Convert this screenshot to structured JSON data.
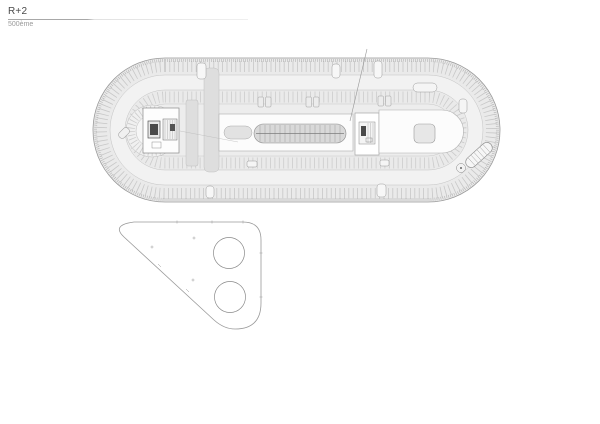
{
  "page": {
    "width": 600,
    "height": 424,
    "background": "#ffffff"
  },
  "titleblock": {
    "title": "R+2",
    "subtitle": "500ème"
  },
  "plan": {
    "upper_figure": "oval-parking-level-plan",
    "upper_features": [
      "perimeter-parking-stalls",
      "circulation-aisles",
      "central-ramp-hatched",
      "helical-ramp",
      "stair-elevator-cores",
      "exterior-stair-detail"
    ],
    "lower_figure": "rounded-triangle-slab-plan",
    "lower_features": [
      "two-circular-openings",
      "survey-tick-marks"
    ],
    "colors": {
      "outline": "#999999",
      "deck_fill": "#eaeaea",
      "aisle_fill": "#f2f2f2",
      "inner_fill": "#ededed",
      "stall_tick": "#c7c7c7",
      "ramp_fill": "#d9d9d9",
      "band_fill": "#dedede",
      "core_white": "#fcfcfc",
      "dark_detail": "#4a4a4a"
    }
  }
}
